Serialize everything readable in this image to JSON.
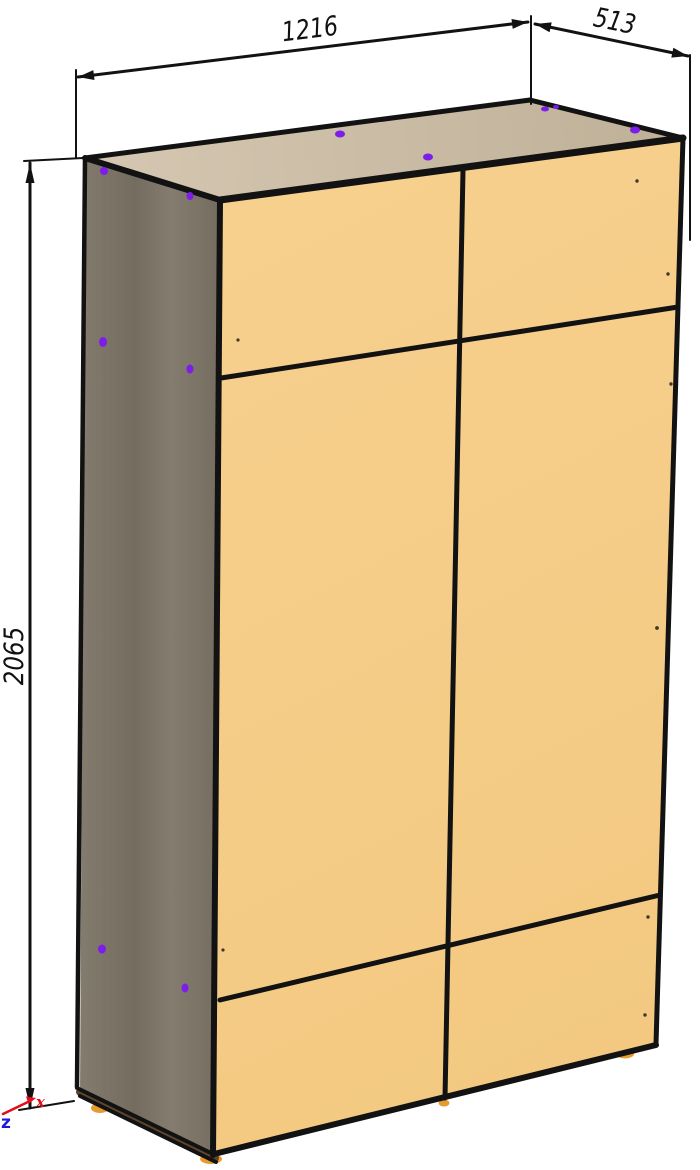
{
  "dimensions": {
    "width": "1216",
    "depth": "513",
    "height": "2065"
  },
  "axis_indicator": {
    "x_label": "x",
    "x_color": "#e20d16",
    "z_label": "z",
    "z_color": "#1b1bdc"
  },
  "colors": {
    "background": "#ffffff",
    "outline": "#121212",
    "front_face_light": "#f7d08e",
    "front_face_dark": "#f3c981",
    "top_face_light": "#d5c7b1",
    "top_face_dark": "#bfb098",
    "side_face_light": "#847c6e",
    "side_face_dark": "#746c5f",
    "plinth_strip": "#5e452d",
    "foot": "#e79a2d",
    "hardware_dot": "#7d1de9",
    "speck": "#40382b"
  }
}
